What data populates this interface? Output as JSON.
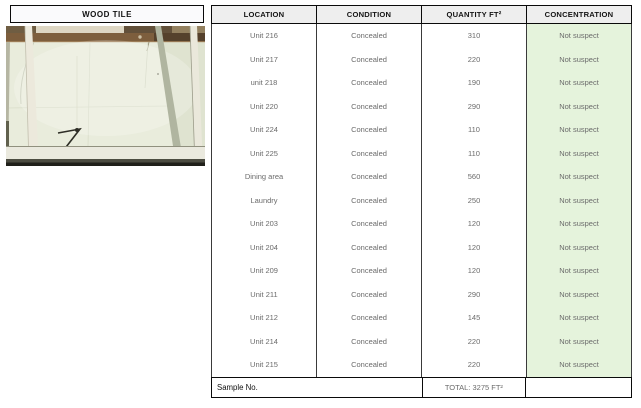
{
  "left_panel": {
    "title": "WOOD TILE",
    "photo": {
      "description": "ceiling interior with wood beam and white framing members"
    }
  },
  "table": {
    "headers": [
      "LOCATION",
      "CONDITION",
      "QUANTITY FT²",
      "CONCENTRATION"
    ],
    "rows": [
      {
        "location": "Unit 216",
        "condition": "Concealed",
        "quantity": "310",
        "concentration": "Not suspect"
      },
      {
        "location": "Unit 217",
        "condition": "Concealed",
        "quantity": "220",
        "concentration": "Not suspect"
      },
      {
        "location": "unit 218",
        "condition": "Concealed",
        "quantity": "190",
        "concentration": "Not suspect"
      },
      {
        "location": "Unit 220",
        "condition": "Concealed",
        "quantity": "290",
        "concentration": "Not suspect"
      },
      {
        "location": "Unit 224",
        "condition": "Concealed",
        "quantity": "110",
        "concentration": "Not suspect"
      },
      {
        "location": "Unit 225",
        "condition": "Concealed",
        "quantity": "110",
        "concentration": "Not suspect"
      },
      {
        "location": "Dining area",
        "condition": "Concealed",
        "quantity": "560",
        "concentration": "Not suspect"
      },
      {
        "location": "Laundry",
        "condition": "Concealed",
        "quantity": "250",
        "concentration": "Not suspect"
      },
      {
        "location": "Unit 203",
        "condition": "Concealed",
        "quantity": "120",
        "concentration": "Not suspect"
      },
      {
        "location": "Unit 204",
        "condition": "Concealed",
        "quantity": "120",
        "concentration": "Not suspect"
      },
      {
        "location": "Unit 209",
        "condition": "Concealed",
        "quantity": "120",
        "concentration": "Not suspect"
      },
      {
        "location": "Unit 211",
        "condition": "Concealed",
        "quantity": "290",
        "concentration": "Not suspect"
      },
      {
        "location": "Unit 212",
        "condition": "Concealed",
        "quantity": "145",
        "concentration": "Not suspect"
      },
      {
        "location": "Unit 214",
        "condition": "Concealed",
        "quantity": "220",
        "concentration": "Not suspect"
      },
      {
        "location": "Unit 215",
        "condition": "Concealed",
        "quantity": "220",
        "concentration": "Not suspect"
      }
    ],
    "footer": {
      "sample_label": "Sample No.",
      "total_label": "TOTAL: 3275 FT²"
    },
    "colors": {
      "concentration_bg": "#e5f3dc",
      "header_bg": "#eeeeee"
    }
  }
}
